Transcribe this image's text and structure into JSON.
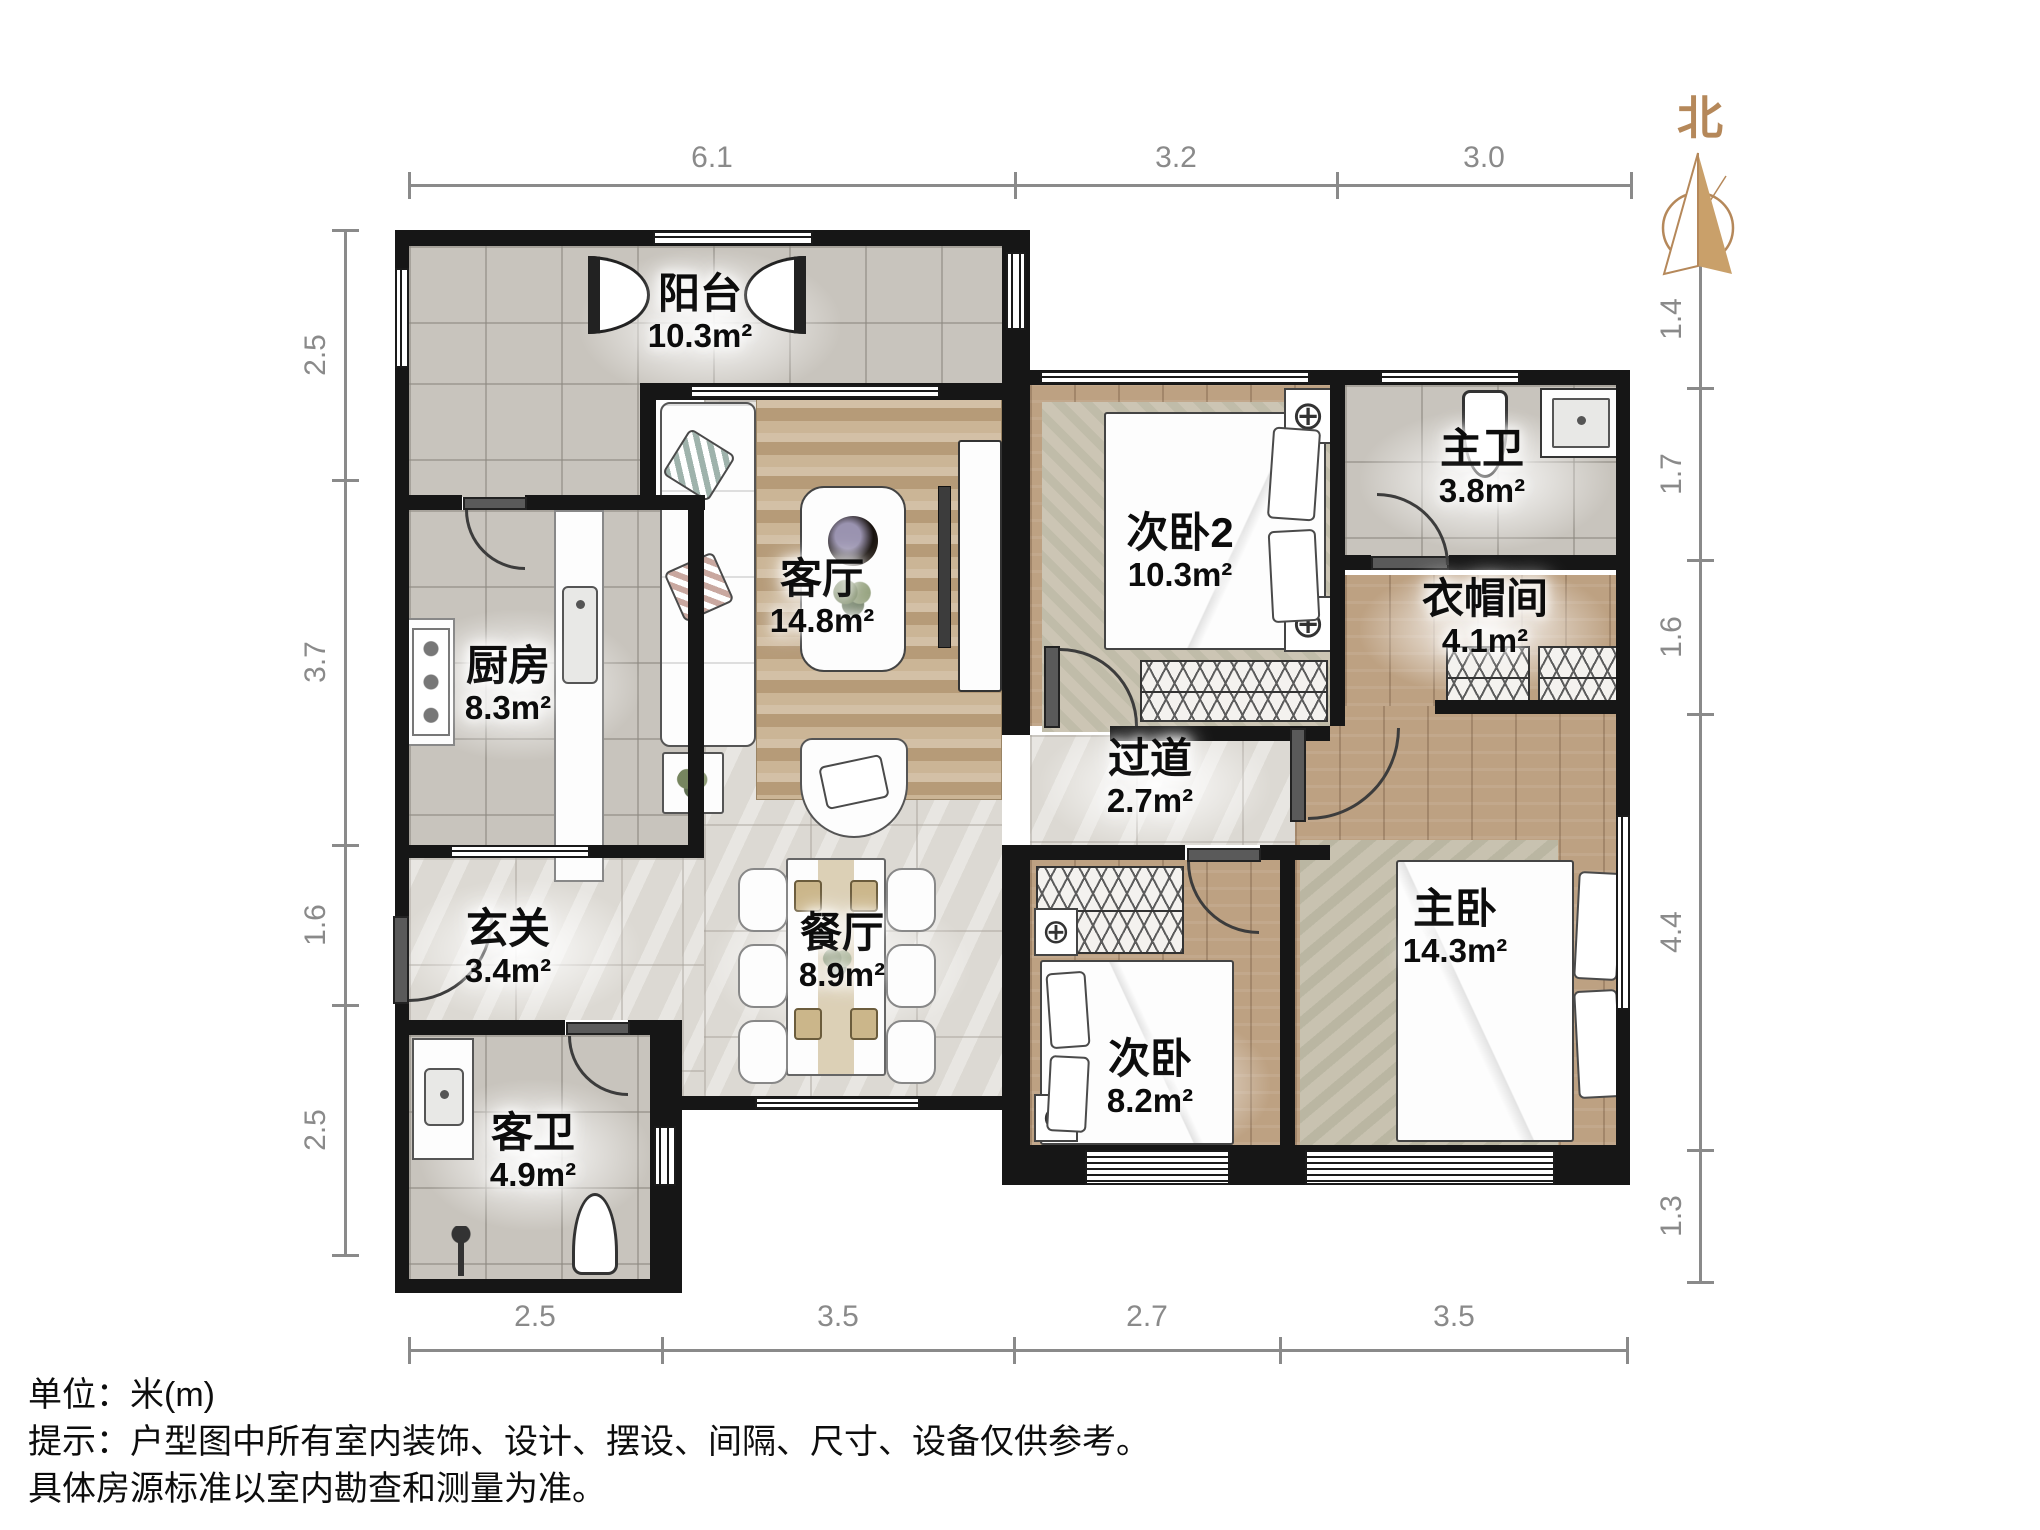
{
  "north_label": "北",
  "rooms": {
    "balcony": {
      "name": "阳台",
      "area": "10.3m²"
    },
    "living": {
      "name": "客厅",
      "area": "14.8m²"
    },
    "kitchen": {
      "name": "厨房",
      "area": "8.3m²"
    },
    "entry": {
      "name": "玄关",
      "area": "3.4m²"
    },
    "dining": {
      "name": "餐厅",
      "area": "8.9m²"
    },
    "guest_bath": {
      "name": "客卫",
      "area": "4.9m²"
    },
    "bedroom2": {
      "name": "次卧2",
      "area": "10.3m²"
    },
    "master_bath": {
      "name": "主卫",
      "area": "3.8m²"
    },
    "cloakroom": {
      "name": "衣帽间",
      "area": "4.1m²"
    },
    "hallway": {
      "name": "过道",
      "area": "2.7m²"
    },
    "bedroom": {
      "name": "次卧",
      "area": "8.2m²"
    },
    "master_bedroom": {
      "name": "主卧",
      "area": "14.3m²"
    }
  },
  "dimensions": {
    "top": [
      "6.1",
      "3.2",
      "3.0"
    ],
    "bottom": [
      "2.5",
      "3.5",
      "2.7",
      "3.5"
    ],
    "left": [
      "2.5",
      "3.7",
      "1.6",
      "2.5"
    ],
    "right": [
      "1.4",
      "1.7",
      "1.6",
      "4.4",
      "1.3"
    ]
  },
  "footer": {
    "line1": "单位：米(m)",
    "line2": "提示：户型图中所有室内装饰、设计、摆设、间隔、尺寸、设备仅供参考。",
    "line3": "具体房源标准以室内勘查和测量为准。"
  },
  "colors": {
    "wall": "#161616",
    "wood_floor": "#bda182",
    "tile_floor": "#c8c4bd",
    "marble_floor": "#dcd9d3",
    "north_accent": "#c9a06a",
    "dimension_gray": "#8a8a8a"
  }
}
